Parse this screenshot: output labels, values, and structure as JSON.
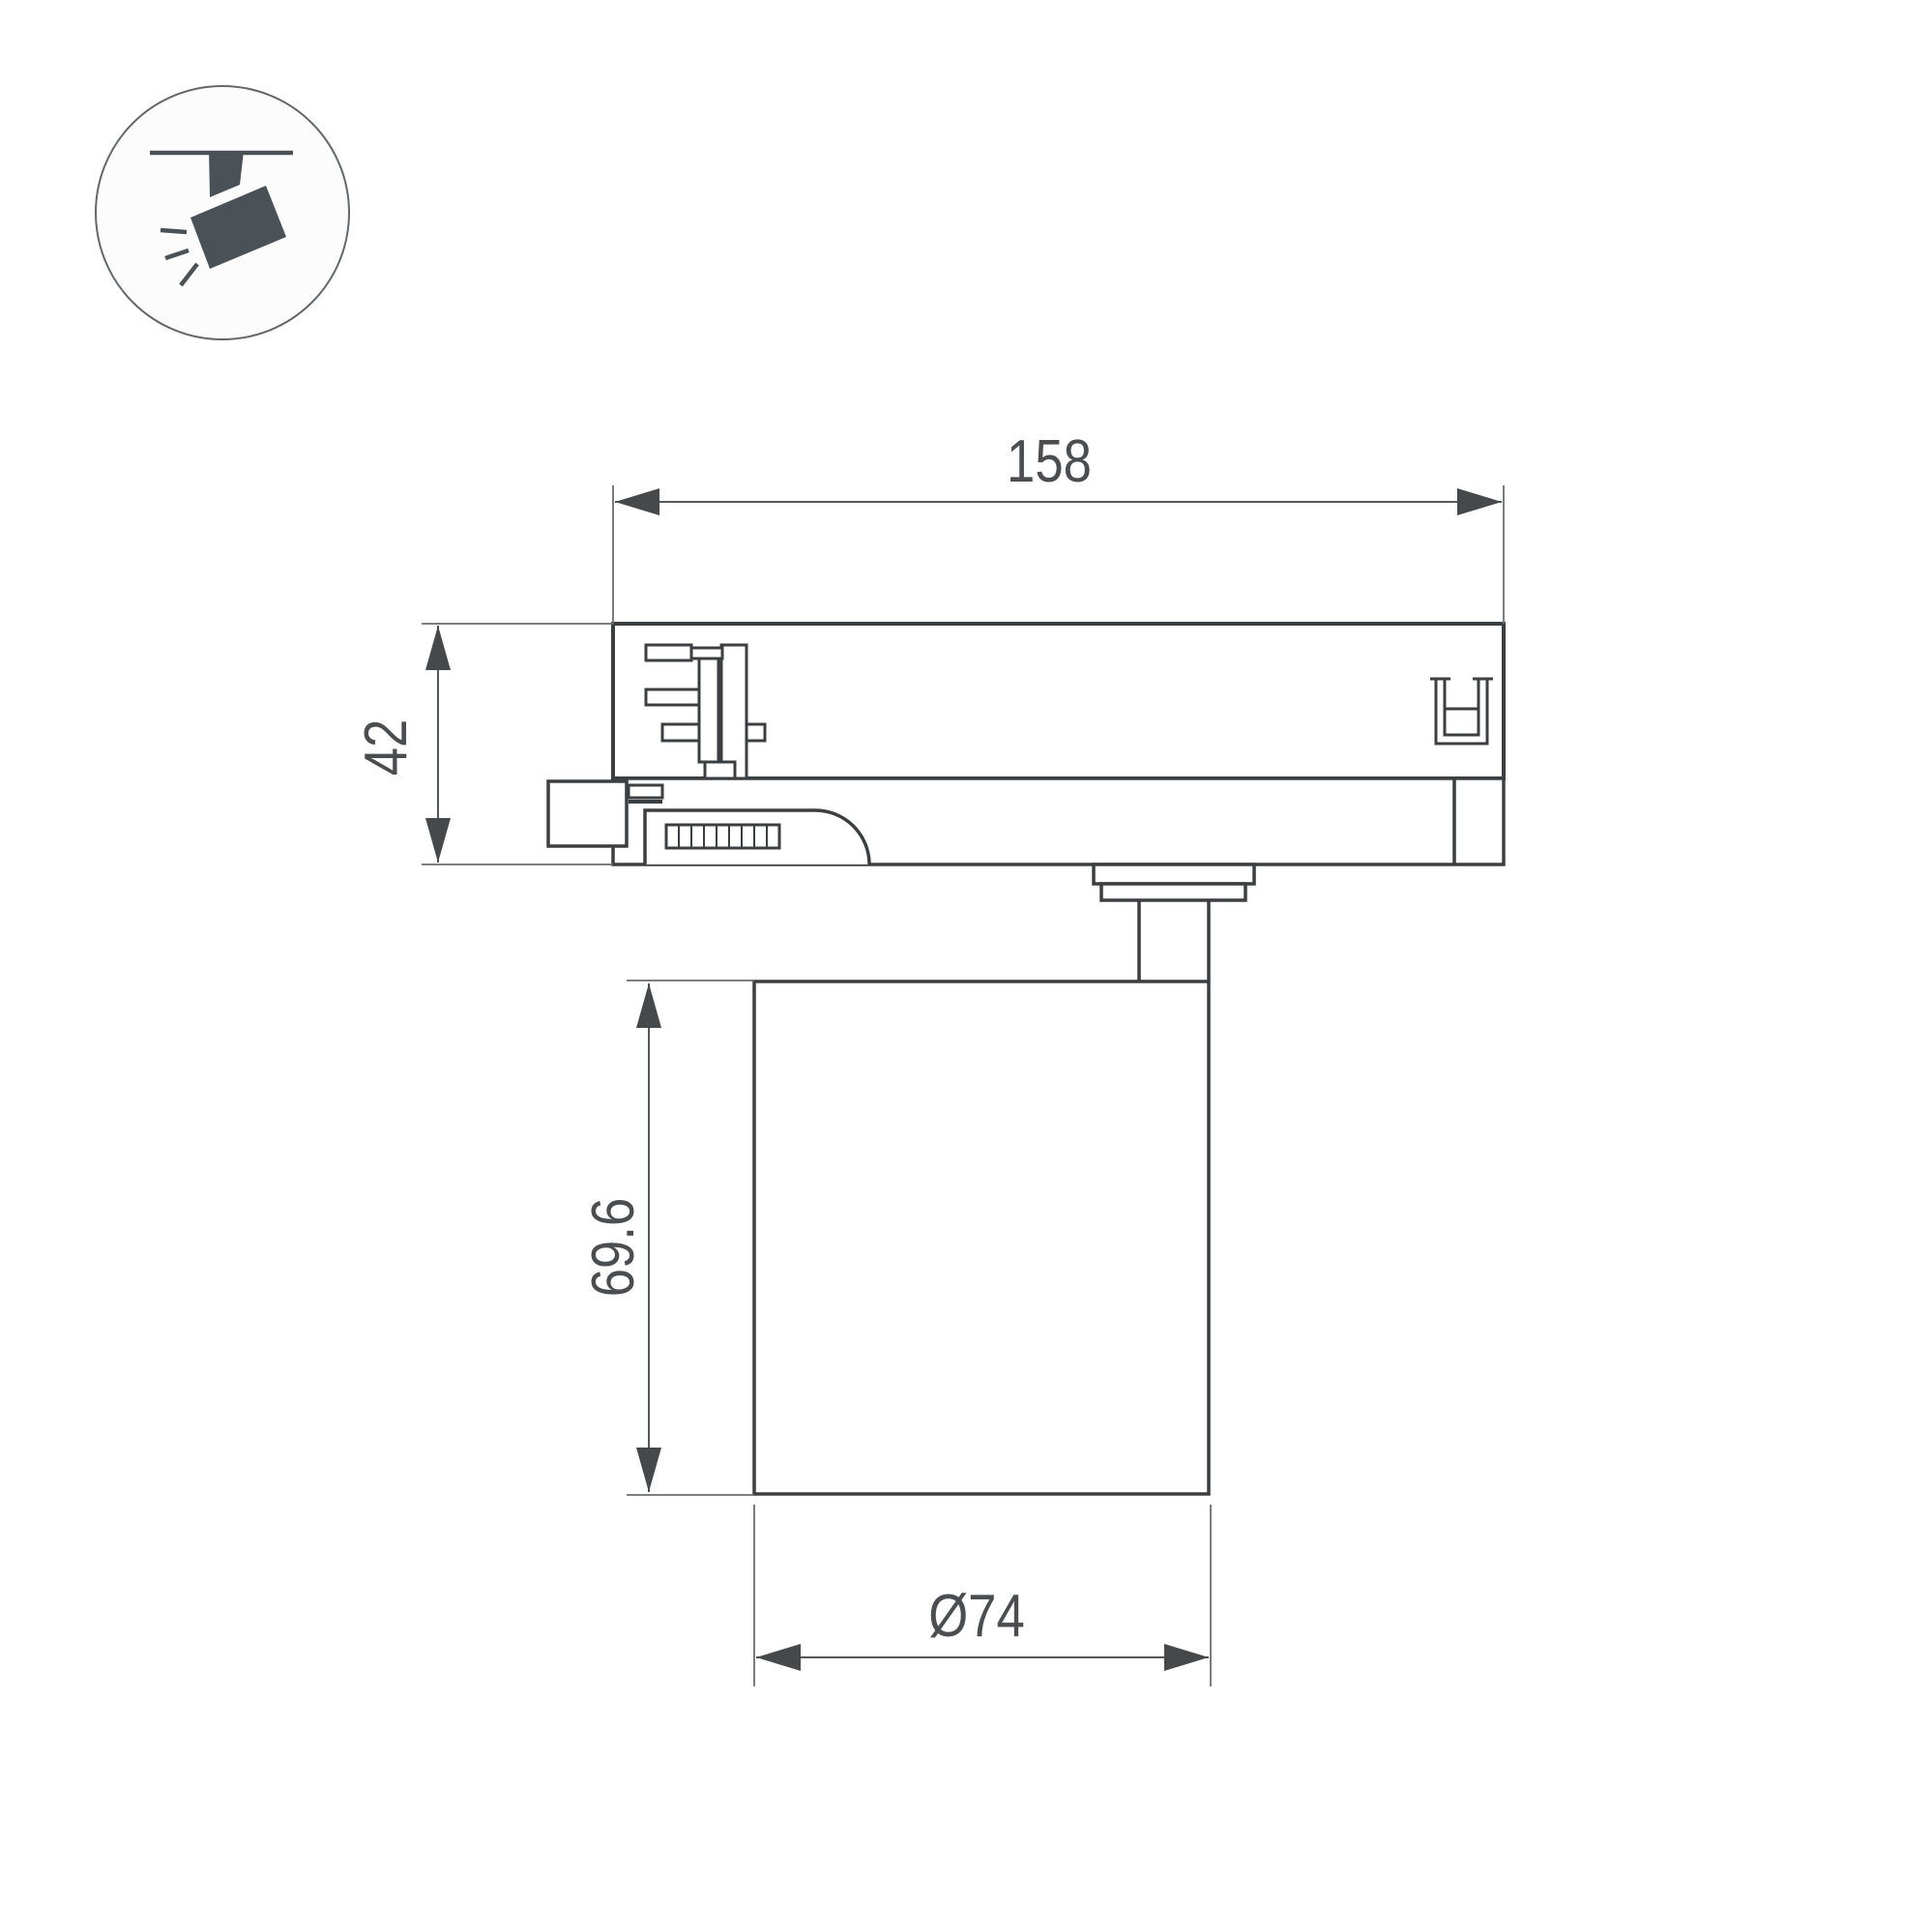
{
  "page": {
    "background": "#ffffff",
    "description": "Technical dimension drawing of a 3-phase track-mounted LED spotlight, side view"
  },
  "legend_icon": {
    "name": "track-spotlight-icon",
    "meaning": "ceiling track mounted spotlight",
    "circle_fill": "#fcfcfc",
    "circle_stroke": "#63686c",
    "shape_color": "#4b5257"
  },
  "drawing": {
    "object": "track light fixture side view with track adapter, pivot stem and cylindrical lamp body",
    "outline_color": "#3c3f41",
    "dimension_color": "#55585b",
    "text_color": "#4b4e51",
    "dimensions": {
      "adapter_width": {
        "label": "158",
        "value": 158,
        "unit": "mm",
        "measures": "track adapter length"
      },
      "adapter_height": {
        "label": "42",
        "value": 42,
        "unit": "mm",
        "measures": "track adapter height"
      },
      "body_height": {
        "label": "69.6",
        "value": 69.6,
        "unit": "mm",
        "measures": "lamp body height"
      },
      "body_diameter": {
        "label": "Ø74",
        "value": 74,
        "unit": "mm",
        "measures": "lamp body diameter"
      }
    }
  }
}
